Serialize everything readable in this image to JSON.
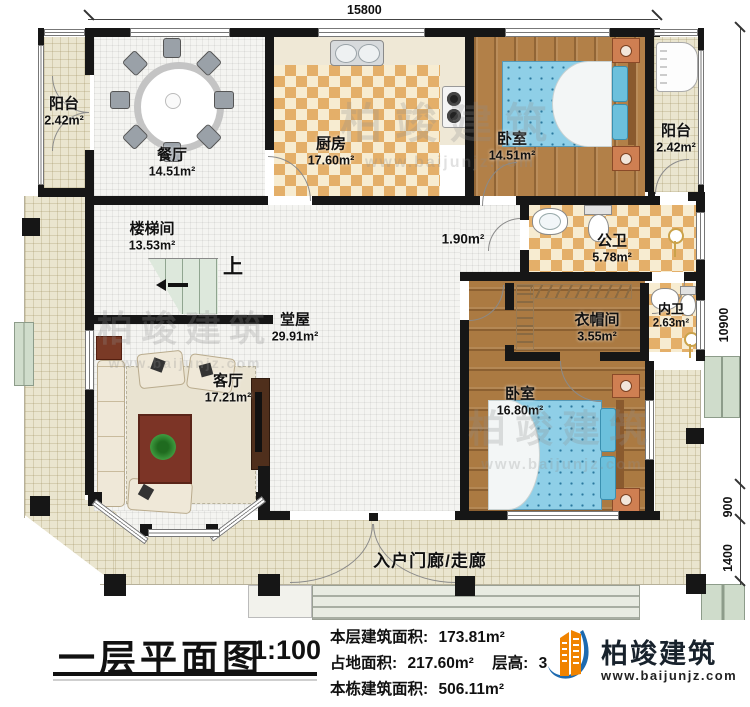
{
  "plan": {
    "dims": {
      "top": "15800",
      "right_main": "10900",
      "right_step": "900",
      "right_porch": "1400"
    },
    "labels": {
      "up": "上"
    },
    "rooms": {
      "balcony_left": {
        "name": "阳台",
        "area": "2.42m²"
      },
      "dining": {
        "name": "餐厅",
        "area": "14.51m²"
      },
      "kitchen": {
        "name": "厨房",
        "area": "17.60m²"
      },
      "bedroom_top": {
        "name": "卧室",
        "area": "14.51m²"
      },
      "balcony_right": {
        "name": "阳台",
        "area": "2.42m²"
      },
      "stair_hall": {
        "name": "楼梯间",
        "area": "13.53m²"
      },
      "corridor": {
        "area": "1.90m²"
      },
      "public_bath": {
        "name": "公卫",
        "area": "5.78m²"
      },
      "cloakroom": {
        "name": "衣帽间",
        "area": "3.55m²"
      },
      "private_bath": {
        "name": "内卫",
        "area": "2.63m²"
      },
      "bedroom_bottom": {
        "name": "卧室",
        "area": "16.80m²"
      },
      "main_hall": {
        "name": "堂屋",
        "area": "29.91m²"
      },
      "living": {
        "name": "客厅",
        "area": "17.21m²"
      },
      "porch": {
        "name": "入户门廊/走廊"
      }
    }
  },
  "watermark": {
    "name": "柏竣建筑",
    "url": "www.baijunjz.com"
  },
  "title_block": {
    "title": "一层平面图",
    "scale": "1:100",
    "lines": [
      {
        "label": "本层建筑面积:",
        "value": "173.81m²"
      },
      {
        "label": "占地面积:",
        "value": "217.60m²",
        "label2": "层高:",
        "value2": "3"
      },
      {
        "label": "本栋建筑面积:",
        "value": "506.11m²"
      }
    ],
    "logo_name": "柏竣建筑",
    "logo_url": "www.baijunjz.com"
  }
}
